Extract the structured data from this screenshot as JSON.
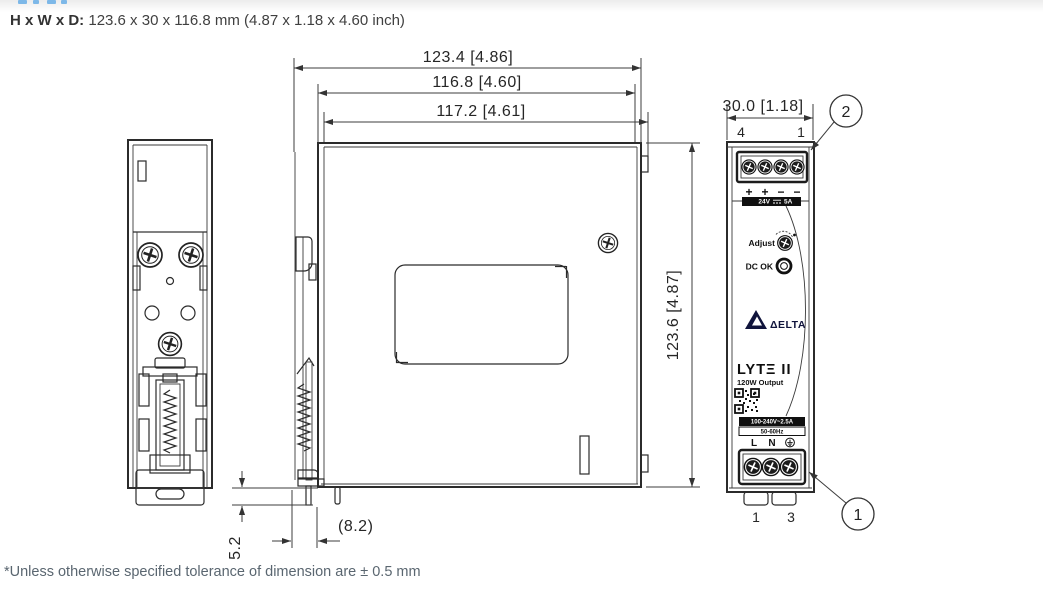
{
  "header": {
    "label": "H x W x D:",
    "value": " 123.6 x 30 x 116.8 mm (4.87 x 1.18 x 4.60 inch)"
  },
  "footer": {
    "note": "*Unless otherwise specified tolerance of dimension are ± 0.5 mm"
  },
  "dims": {
    "depth_overall": "123.4 [4.86]",
    "depth_body": "116.8 [4.60]",
    "depth_front": "117.2 [4.61]",
    "height": "123.6 [4.87]",
    "width": "30.0 [1.18]",
    "din_offset": "(8.2)",
    "clip_travel": "5.2"
  },
  "callouts": {
    "output_terminal": "2",
    "input_terminal": "1"
  },
  "front": {
    "top_pins": [
      "4",
      "1"
    ],
    "polarity": [
      "+",
      "+",
      "−",
      "−"
    ],
    "output_voltage": "24V",
    "output_current": "5A",
    "adjust_label": "Adjust",
    "dc_ok_label": "DC OK",
    "brand": "ΔELTA",
    "model": "LYTΞ II",
    "output_power": "120W Output",
    "input_rating": "100-240V~2.5A",
    "input_freq": "50-60Hz",
    "line_label": "L",
    "neutral_label": "N",
    "bottom_pins": [
      "1",
      "3"
    ]
  }
}
